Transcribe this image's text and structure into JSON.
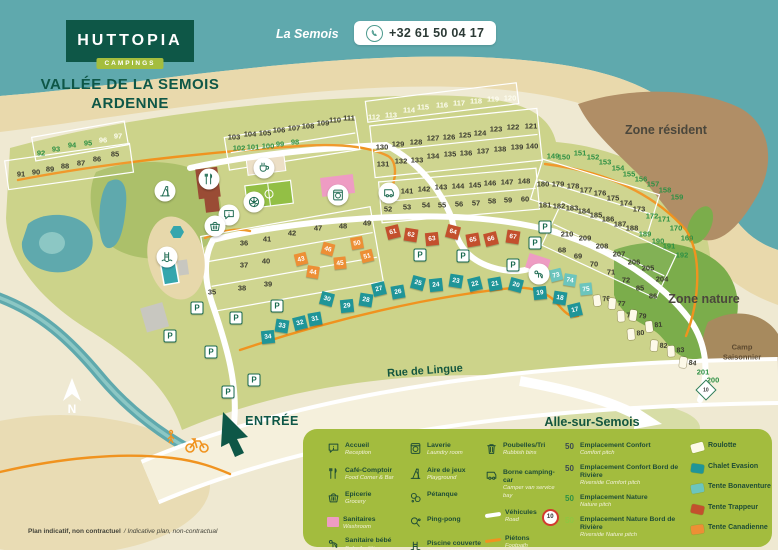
{
  "header": {
    "logo": "HUTTOPIA",
    "logo_sub": "CAMPINGS",
    "title_line1": "VALLÉE DE LA SEMOIS",
    "title_line2": "ARDENNE",
    "river_label": "La Semois",
    "phone": "+32 61 50 04 17"
  },
  "colors": {
    "brand_green": "#0e5747",
    "badge_green": "#a4bd3e",
    "water": "#5fa9ad",
    "sand": "#e9d9ac",
    "pitch_area": "#ccd38a",
    "zone_nature": "#7bad4b",
    "zone_resident": "#b08e66",
    "legend_bg": "#a3bc3e",
    "path_orange": "#f0931f",
    "chalet": "#1f9598",
    "bonaventure": "#6cc5bd",
    "trappeur": "#c3502d",
    "canadienne": "#ed8f35",
    "roulotte": "#fdf9e8",
    "pink": "#ee9cc3",
    "num_dark": "#3b3b2f",
    "num_green": "#2e9044",
    "num_light": "#fdfdf0"
  },
  "map": {
    "zones": {
      "resident": "Zone résident",
      "nature": "Zone nature",
      "seasonal_line1": "Camp",
      "seasonal_line2": "Saisonnier"
    },
    "roads": {
      "street": "Rue de Lingue",
      "destination": "Alle-sur-Semois"
    },
    "entrance": "ENTRÉE",
    "compass": "N",
    "speed_sign": "10",
    "disclaimer_fr": "Plan indicatif, non contractuel",
    "disclaimer_en": "/ Indicative plan, non-contractual",
    "parking_label": "P",
    "parkings": [
      [
        197,
        308
      ],
      [
        236,
        318
      ],
      [
        277,
        306
      ],
      [
        420,
        255
      ],
      [
        463,
        256
      ],
      [
        513,
        265
      ],
      [
        545,
        227
      ],
      [
        535,
        243
      ],
      [
        170,
        336
      ],
      [
        254,
        380
      ],
      [
        228,
        392
      ],
      [
        211,
        352
      ]
    ],
    "amenities": [
      {
        "icon": "slide",
        "x": 165,
        "y": 191
      },
      {
        "icon": "football",
        "x": 254,
        "y": 202
      },
      {
        "icon": "cutlery",
        "x": 209,
        "y": 179
      },
      {
        "icon": "coffee",
        "x": 264,
        "y": 168
      },
      {
        "icon": "laundry",
        "x": 338,
        "y": 195
      },
      {
        "icon": "info",
        "x": 229,
        "y": 215
      },
      {
        "icon": "basket",
        "x": 215,
        "y": 226
      },
      {
        "icon": "pool",
        "x": 167,
        "y": 257
      },
      {
        "icon": "baby",
        "x": 539,
        "y": 274
      },
      {
        "icon": "camper",
        "x": 389,
        "y": 193
      }
    ],
    "pitch_groups": [
      {
        "name": "comfort",
        "kind": "label",
        "class": "num-dark",
        "items": [
          [
            91,
            21,
            174
          ],
          [
            90,
            36,
            172
          ],
          [
            89,
            50,
            169
          ],
          [
            88,
            65,
            166
          ],
          [
            87,
            81,
            163
          ],
          [
            86,
            97,
            159
          ],
          [
            85,
            115,
            154
          ],
          [
            103,
            234,
            137
          ],
          [
            104,
            250,
            134
          ],
          [
            105,
            265,
            133
          ],
          [
            106,
            279,
            130
          ],
          [
            107,
            294,
            128
          ],
          [
            108,
            308,
            126
          ],
          [
            109,
            323,
            123
          ],
          [
            110,
            335,
            120
          ],
          [
            111,
            349,
            118
          ],
          [
            121,
            531,
            126
          ],
          [
            122,
            513,
            127
          ],
          [
            123,
            496,
            129
          ],
          [
            124,
            480,
            133
          ],
          [
            125,
            465,
            135
          ],
          [
            126,
            449,
            137
          ],
          [
            127,
            433,
            138
          ],
          [
            128,
            416,
            142
          ],
          [
            129,
            398,
            144
          ],
          [
            130,
            382,
            147
          ],
          [
            131,
            383,
            164
          ],
          [
            132,
            401,
            161
          ],
          [
            133,
            417,
            160
          ],
          [
            134,
            433,
            156
          ],
          [
            135,
            450,
            154
          ],
          [
            136,
            466,
            153
          ],
          [
            137,
            483,
            151
          ],
          [
            138,
            500,
            149
          ],
          [
            139,
            517,
            147
          ],
          [
            140,
            532,
            146
          ],
          [
            141,
            407,
            191
          ],
          [
            142,
            424,
            189
          ],
          [
            143,
            441,
            187
          ],
          [
            144,
            458,
            186
          ],
          [
            145,
            475,
            185
          ],
          [
            146,
            490,
            183
          ],
          [
            147,
            507,
            182
          ],
          [
            148,
            524,
            181
          ],
          [
            52,
            388,
            209
          ],
          [
            53,
            407,
            207
          ],
          [
            54,
            426,
            205
          ],
          [
            55,
            442,
            205
          ],
          [
            56,
            459,
            204
          ],
          [
            57,
            476,
            203
          ],
          [
            58,
            492,
            201
          ],
          [
            59,
            508,
            200
          ],
          [
            60,
            525,
            199
          ],
          [
            36,
            244,
            243
          ],
          [
            41,
            267,
            239
          ],
          [
            42,
            292,
            233
          ],
          [
            47,
            318,
            228
          ],
          [
            48,
            343,
            226
          ],
          [
            49,
            367,
            223
          ],
          [
            37,
            244,
            265
          ],
          [
            40,
            266,
            261
          ],
          [
            35,
            212,
            292
          ],
          [
            38,
            242,
            288
          ],
          [
            39,
            268,
            284
          ],
          [
            173,
            639,
            209
          ],
          [
            174,
            626,
            203
          ],
          [
            175,
            613,
            198
          ],
          [
            176,
            600,
            193
          ],
          [
            177,
            586,
            190
          ],
          [
            178,
            573,
            186
          ],
          [
            179,
            558,
            184
          ],
          [
            180,
            543,
            184
          ],
          [
            181,
            545,
            205
          ],
          [
            182,
            559,
            206
          ],
          [
            183,
            572,
            208
          ],
          [
            184,
            584,
            211
          ],
          [
            185,
            596,
            215
          ],
          [
            186,
            608,
            219
          ],
          [
            187,
            620,
            224
          ],
          [
            188,
            632,
            228
          ],
          [
            210,
            567,
            234
          ],
          [
            209,
            585,
            238
          ],
          [
            208,
            602,
            246
          ],
          [
            207,
            619,
            254
          ],
          [
            206,
            634,
            262
          ],
          [
            205,
            648,
            268
          ],
          [
            204,
            662,
            279
          ],
          [
            68,
            562,
            250
          ],
          [
            69,
            578,
            256
          ],
          [
            70,
            594,
            264
          ],
          [
            71,
            611,
            272
          ],
          [
            72,
            626,
            280
          ],
          [
            85,
            640,
            288
          ],
          [
            86,
            653,
            296
          ]
        ]
      },
      {
        "name": "nature",
        "kind": "label",
        "class": "num-green",
        "items": [
          [
            92,
            41,
            153
          ],
          [
            93,
            56,
            149
          ],
          [
            94,
            72,
            145
          ],
          [
            95,
            88,
            143
          ],
          [
            98,
            295,
            142
          ],
          [
            99,
            280,
            144
          ],
          [
            100,
            268,
            146
          ],
          [
            101,
            253,
            147
          ],
          [
            102,
            239,
            148
          ],
          [
            149,
            553,
            156
          ],
          [
            150,
            564,
            157
          ],
          [
            151,
            580,
            153
          ],
          [
            152,
            593,
            157
          ],
          [
            153,
            605,
            162
          ],
          [
            154,
            618,
            168
          ],
          [
            155,
            629,
            174
          ],
          [
            156,
            641,
            179
          ],
          [
            157,
            653,
            184
          ],
          [
            158,
            665,
            190
          ],
          [
            159,
            677,
            197
          ],
          [
            169,
            687,
            238
          ],
          [
            170,
            676,
            228
          ],
          [
            171,
            664,
            219
          ],
          [
            172,
            652,
            216
          ],
          [
            189,
            645,
            234
          ],
          [
            190,
            658,
            241
          ],
          [
            191,
            669,
            246
          ],
          [
            192,
            682,
            255
          ],
          [
            200,
            713,
            380
          ],
          [
            201,
            703,
            372
          ]
        ]
      },
      {
        "name": "riverside",
        "kind": "label",
        "class": "num-light",
        "items": [
          [
            96,
            103,
            140
          ],
          [
            97,
            118,
            136
          ],
          [
            112,
            374,
            117
          ],
          [
            113,
            391,
            115
          ],
          [
            114,
            409,
            110
          ],
          [
            115,
            423,
            107
          ],
          [
            116,
            442,
            105
          ],
          [
            117,
            459,
            103
          ],
          [
            118,
            476,
            101
          ],
          [
            119,
            493,
            99
          ],
          [
            120,
            510,
            98
          ]
        ]
      },
      {
        "name": "chalet-evasion",
        "kind": "square",
        "class": "sq-chalet",
        "items": [
          [
            17,
            575,
            310
          ],
          [
            18,
            560,
            298
          ],
          [
            19,
            540,
            293
          ],
          [
            20,
            516,
            285
          ],
          [
            21,
            495,
            284
          ],
          [
            22,
            475,
            284
          ],
          [
            23,
            456,
            281
          ],
          [
            24,
            436,
            285
          ],
          [
            25,
            418,
            283
          ],
          [
            26,
            398,
            292
          ],
          [
            27,
            379,
            289
          ],
          [
            28,
            366,
            300
          ],
          [
            29,
            347,
            306
          ],
          [
            30,
            327,
            299
          ],
          [
            31,
            315,
            319
          ],
          [
            32,
            300,
            323
          ],
          [
            33,
            282,
            326
          ],
          [
            34,
            268,
            337
          ]
        ]
      },
      {
        "name": "tente-bonaventure",
        "kind": "square",
        "class": "sq-bona",
        "items": [
          [
            73,
            556,
            275
          ],
          [
            74,
            570,
            280
          ],
          [
            75,
            586,
            289
          ]
        ]
      },
      {
        "name": "tente-trappeur",
        "kind": "square",
        "class": "sq-trap",
        "items": [
          [
            61,
            393,
            232
          ],
          [
            62,
            411,
            235
          ],
          [
            63,
            432,
            239
          ],
          [
            64,
            453,
            232
          ],
          [
            65,
            473,
            240
          ],
          [
            66,
            491,
            239
          ],
          [
            67,
            513,
            237
          ]
        ]
      },
      {
        "name": "tente-canadienne",
        "kind": "square",
        "class": "sq-cana",
        "items": [
          [
            43,
            301,
            259
          ],
          [
            44,
            313,
            272
          ],
          [
            45,
            340,
            263
          ],
          [
            46,
            328,
            249
          ],
          [
            50,
            357,
            243
          ],
          [
            51,
            367,
            256
          ]
        ]
      },
      {
        "name": "roulotte",
        "kind": "roulotte",
        "class": "sq-roul",
        "items": [
          [
            76,
            602,
            300
          ],
          [
            77,
            617,
            304
          ],
          [
            78,
            626,
            316
          ],
          [
            79,
            638,
            316
          ],
          [
            80,
            636,
            334
          ],
          [
            81,
            654,
            326
          ],
          [
            82,
            659,
            346
          ],
          [
            83,
            676,
            351
          ],
          [
            84,
            688,
            363
          ]
        ]
      }
    ]
  },
  "legend": {
    "facilities_col1": [
      {
        "icon": "info",
        "fr": "Accueil",
        "en": "Reception"
      },
      {
        "icon": "cutlery",
        "fr": "Café-Comptoir",
        "en": "Food Corner & Bar"
      },
      {
        "icon": "basket",
        "fr": "Epicerie",
        "en": "Grocery"
      },
      {
        "icon": "pinksq",
        "fr": "Sanitaires",
        "en": "Washroom"
      },
      {
        "icon": "baby",
        "fr": "Sanitaire bébé",
        "en": "Baby facilities"
      }
    ],
    "facilities_col2": [
      {
        "icon": "laundry",
        "fr": "Laverie",
        "en": "Laundry room"
      },
      {
        "icon": "slide",
        "fr": "Aire de jeux",
        "en": "Playground"
      },
      {
        "icon": "petanque",
        "fr": "Pétanque",
        "en": ""
      },
      {
        "icon": "pingpong",
        "fr": "Ping-pong",
        "en": ""
      },
      {
        "icon": "pool",
        "fr": "Piscine couverte",
        "en": "Covered swimming pool"
      }
    ],
    "facilities_col3": [
      {
        "icon": "bin",
        "fr": "Poubelles/Tri",
        "en": "Rubbish bins"
      },
      {
        "icon": "camper",
        "fr": "Borne camping-car",
        "en": "Camper van service bay"
      },
      {
        "icon": "road",
        "fr": "Véhicules",
        "en": "Road",
        "extra": "10"
      },
      {
        "icon": "footpath",
        "fr": "Piétons",
        "en": "Footpath"
      }
    ],
    "pitch_types": [
      {
        "count": "50",
        "color": "#3b4a52",
        "fr": "Emplacement Confort",
        "en": "Comfort pitch"
      },
      {
        "count": "50",
        "color": "#3b4a52",
        "fr": "Emplacement Confort Bord de Rivière",
        "en": "Riverside Comfort pitch"
      },
      {
        "count": "50",
        "color": "#2f9145",
        "fr": "Emplacement Nature",
        "en": "Nature pitch"
      },
      {
        "count": "50",
        "color": "#8fc640",
        "fr": "Emplacement Nature Bord de Rivière",
        "en": "Riverside Nature pitch"
      }
    ],
    "accommodations": [
      {
        "swatch": "#fdf9e8",
        "fr": "Roulotte"
      },
      {
        "swatch": "#1f9598",
        "fr": "Chalet Evasion"
      },
      {
        "swatch": "#6cc5bd",
        "fr": "Tente Bonaventure"
      },
      {
        "swatch": "#c3502d",
        "fr": "Tente Trappeur"
      },
      {
        "swatch": "#ed8f35",
        "fr": "Tente Canadienne"
      }
    ]
  }
}
